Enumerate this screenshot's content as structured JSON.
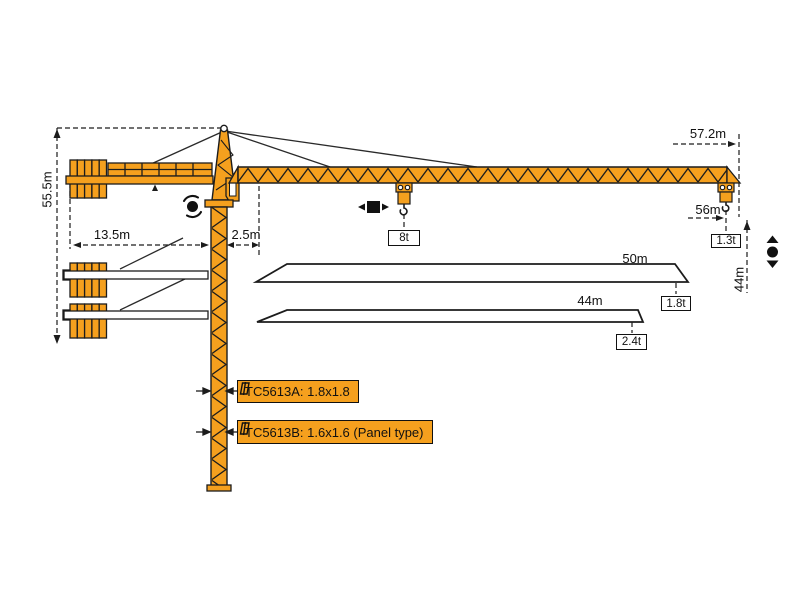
{
  "diagram_title": "TC5613 tower crane working range diagram",
  "colors": {
    "crane_orange": "#F5A01E",
    "outline": "#1c1c1c",
    "background": "#ffffff"
  },
  "dims": {
    "tower_height": "55.5m",
    "counter_jib_radius": "13.5m",
    "rear_offset": "2.5m",
    "max_radius": "57.2m",
    "hook_radius": "56m",
    "hook_height_right": "44m"
  },
  "loads": {
    "max_load": "8t",
    "tip_load_56m": "1.3t",
    "tip_load_50m": "1.8t",
    "tip_load_44m": "2.4t"
  },
  "jib_variants": {
    "len_50": "50m",
    "len_44": "44m"
  },
  "mast_sections": {
    "a": "TC5613A: 1.8x1.8",
    "b": "TC5613B: 1.6x1.6 (Panel type)"
  },
  "icons": {
    "slewing": "slewing-icon",
    "trolley": "trolley-travel-icon",
    "hoist": "hoist-icon",
    "mast_section": "mast-section-icon"
  }
}
